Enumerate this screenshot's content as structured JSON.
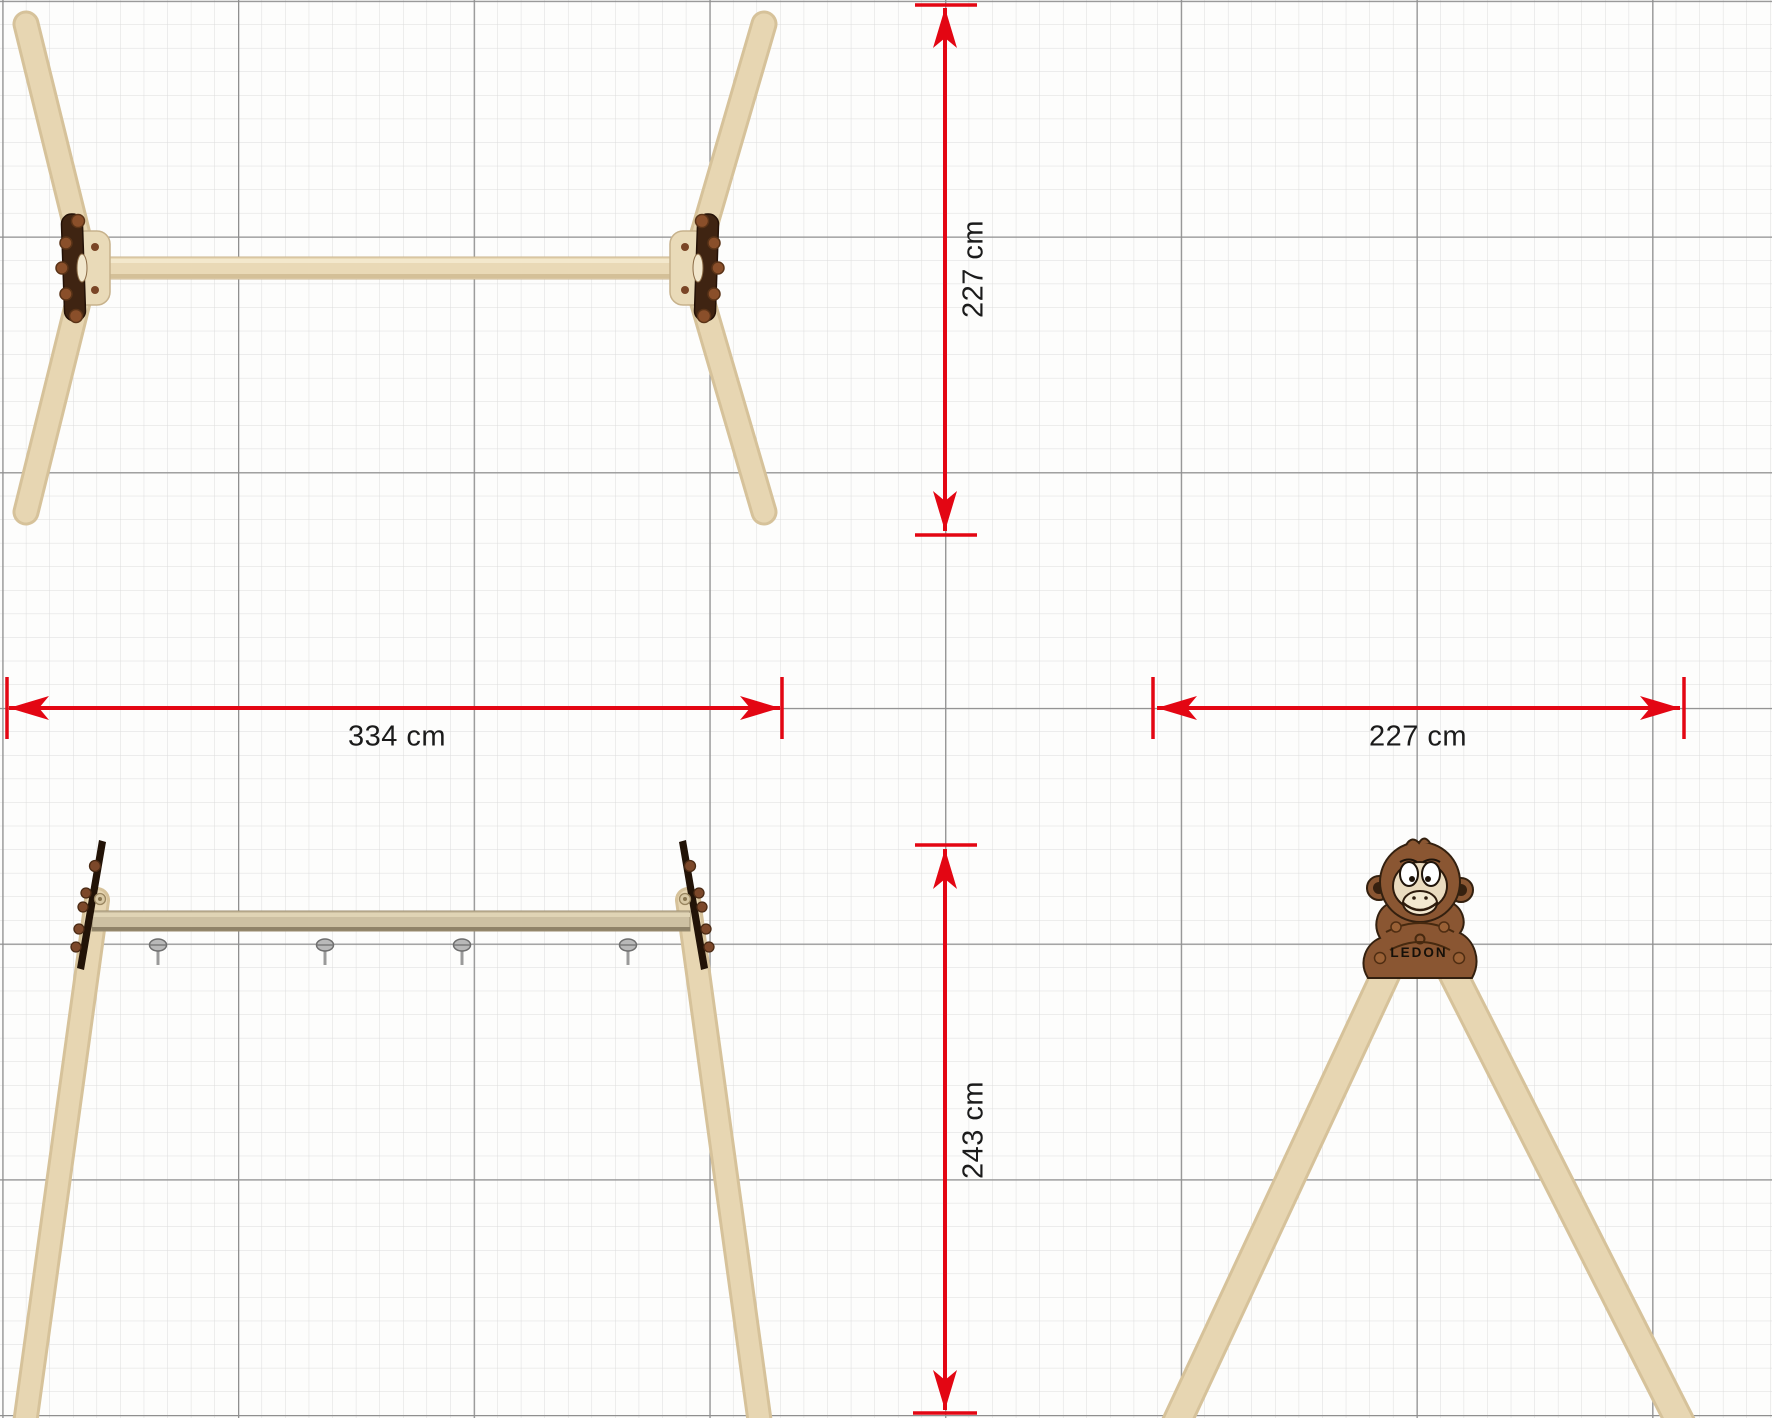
{
  "drawing_title": "swing frame dimensional drawing",
  "dimensions": {
    "overall_width": {
      "label": "334 cm",
      "orientation": "horizontal"
    },
    "frame_depth": {
      "label": "227 cm",
      "orientation": "vertical"
    },
    "frame_width": {
      "label": "227 cm",
      "orientation": "horizontal"
    },
    "frame_height": {
      "label": "243 cm",
      "orientation": "vertical"
    }
  },
  "branding": {
    "logo_text": "LEDON"
  },
  "colors": {
    "dimension_red": "#e30613",
    "wood_light": "#e7d6b2",
    "wood_beam_front": "#cdc0a2",
    "bracket_dark": "#241409",
    "panel_brown": "#8a5632",
    "grid_minor": "#dcdcdc",
    "grid_major": "#8f8f8f",
    "label_text": "#1b1b1b"
  }
}
